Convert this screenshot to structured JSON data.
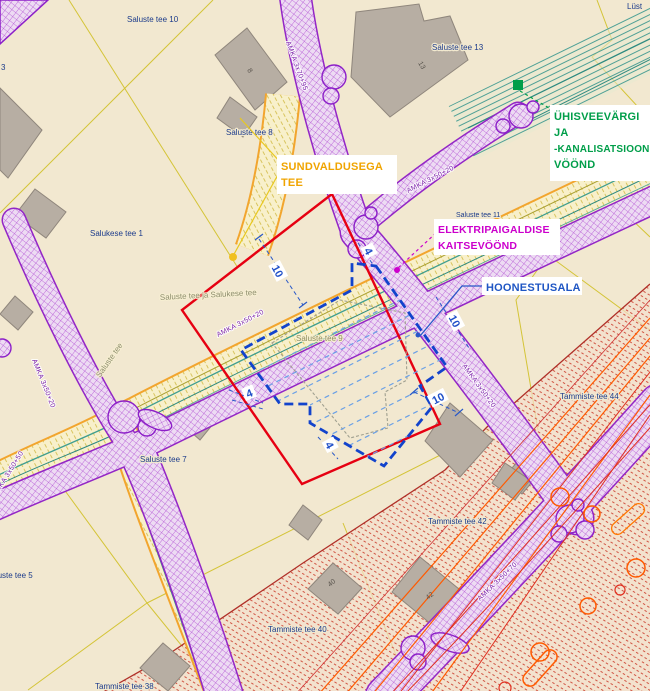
{
  "map": {
    "callouts": {
      "sundvaldusega_tee": {
        "line1": "SUNDVALDUSEGA",
        "line2": "TEE",
        "color": "#f0a400"
      },
      "uhisveevargi": {
        "line1": "ÜHISVEEVÄRGI",
        "line2": "JA",
        "line3": "-KANALISATSIOONI",
        "line4": "VÖÖND",
        "color": "#009e49"
      },
      "elektripaigaldise": {
        "line1": "ELEKTRIPAIGALDISE",
        "line2": "KAITSEVÖÖND",
        "color": "#cc00cc"
      },
      "hoonestusala": {
        "line1": "HOONESTUSALA",
        "color": "#1f56c4"
      }
    },
    "parcel_labels": {
      "lust": "Lüst",
      "saluste_tee_10": "Saluste tee 10",
      "saluste_tee_13": "Saluste tee 13",
      "saluste_tee_8": "Saluste tee 8",
      "salukese_tee_1": "Salukese tee 1",
      "saluste_tee_11": "Saluste tee 11",
      "saluste_tee_9": "Saluste tee 9",
      "saluste_tee_7": "Saluste tee 7",
      "saluste_tee_5": "Saluste tee 5",
      "tammiste_tee_44": "Tammiste tee 44",
      "tammiste_tee_42": "Tammiste tee 42",
      "tammiste_tee_40": "Tammiste tee 40",
      "tammiste_tee_38": "Tammiste tee 38",
      "partial_3": "3"
    },
    "road_labels": {
      "saluste_ja_salukese": "Saluste tee ja Salukese tee",
      "saluste": "Saluste tee"
    },
    "cable_labels": {
      "amka_3x70_95": "AMKA 3x70+95",
      "amka_3x50_20": "AMKA 3x50+20",
      "amka_3x50_70": "AMKA 3x50+70",
      "amka_3x50_50": "AMKA 3x50+50"
    },
    "dimensions": {
      "ten": "10",
      "four": "4"
    },
    "building_numbers": {
      "b13": "13",
      "b42": "42",
      "b40": "40",
      "b8": "8"
    },
    "legend_colors": {
      "sundvalduse_tee_boundary": "#e60012",
      "hoonestusala_outline": "#1243cc",
      "elektripaigaldise_zone": "#9326c6",
      "uhisveevargi_zone": "#009e49",
      "road_edge": "#f2a52e",
      "restriction_hatch": "#cc4433"
    }
  }
}
